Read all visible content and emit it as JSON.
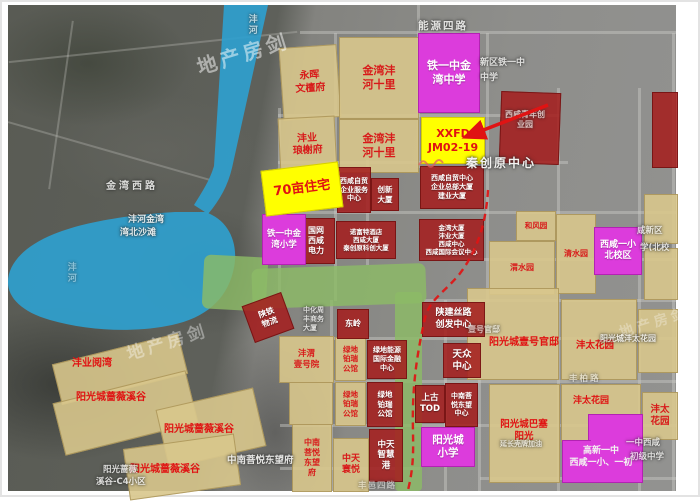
{
  "watermark": {
    "text": "地产房剑"
  },
  "colors": {
    "water": "#2f9fce",
    "park_green": "#8cbb67",
    "highlight_yellow": "#ffff00",
    "school_magenta": "#dc3cdc",
    "office_red": "#a41f1f",
    "residential_tan": "#d8c68c",
    "label_red": "#e01212",
    "route_red": "#e01313"
  },
  "blocks": {
    "zhuzhai70": "70亩住宅",
    "xxfd": "XXFD\nJM02-19",
    "tieyi_zhongxue": "铁一中金\n湾中学",
    "tieyi_xiaoxue": "铁一中金\n湾小学",
    "xixian_yixiao_bei": "西咸一小\n北校区",
    "gaoxin_yizhong": "高新一中\n西咸一小、一初",
    "yangguangcheng_xiaoxue": "阳光城\n小学",
    "ziyou_fuwu": "西咸自贸\n企业服务\n中心",
    "chuangxin_dasha": "创新\n大厦",
    "zongbu_dasha": "西咸自贸中心\n企业总部大厦\n建业大厦",
    "guowang_dianli": "国网\n西咸\n电力",
    "nuofute": "诺富特酒店\n西咸大厦\n秦创原科创大厦",
    "jinwan_dasha": "金湾大厦\n沣业大厦\n西咸中心\n西咸国际会议中心",
    "dongling": "东岭",
    "lvdi_jinrong": "绿地能源\n国际金融\n中心",
    "lvdi_bairui_hong": "绿地\n铂瑞\n公馆",
    "zhongtian_zhihuigang": "中天\n智慧\n港",
    "shanjian_silu": "陕建丝路\n创发中心",
    "tianzhong_zhongxin": "天众\n中心",
    "shanggu_tod": "上古\nTOD",
    "zhongnan_zhongxin": "中南菩\n悦东望\n中心",
    "shantie_wuliu": "陕铁\n物流",
    "yonghui": "永晖\n文檀府",
    "jinwan_shili_1": "金湾沣\n河十里",
    "jinwan_shili_2": "金湾沣\n河十里",
    "fengye_langxie": "沣业\n琅榭府",
    "hefengyuan": "和风园",
    "weishuiyuan": "渭水园",
    "qingshuiyuan": "清水园",
    "fengwei_yihaoyuan": "沣渭\n壹号院",
    "lvdi_bairui_1": "绿地\n铂瑞\n公馆",
    "lvdi_bairui_2": "绿地\n铂瑞\n公馆",
    "zhongnan_dongwangfu": "中南\n菩悦\n东望\n府",
    "zhongtian_huanyue": "中天\n寰悦",
    "fengtai_small": "沣太\n花园"
  },
  "area_labels": {
    "fengye_yuewan": "沣业阅湾",
    "qiangwei_1": "阳光城蔷薇溪谷",
    "qiangwei_2": "阳光城蔷薇溪谷",
    "qiangwei_3": "阳光城蔷薇溪谷",
    "yihao_guandi": "阳光城壹号官邸",
    "fengtai_1": "沣太花园",
    "fengtai_2": "沣太花园",
    "basai": "阳光城巴塞\n阳光"
  },
  "bg_labels": {
    "nengyuan_silu": "能源四路",
    "jinwan_xilu": "金湾西路",
    "qinchuangyuan": "秦创原中心",
    "fenghe_jinwan": "沣河金湾",
    "wanbei_shatan": "湾北沙滩",
    "fenghe_river": "沣河",
    "fenghe_lake": "沣河",
    "xinqu_tieyi": "新区铁一中",
    "zhongxue": "中学",
    "qingnian_chuangye": "西咸青年创\n业园",
    "xian_xinqu": "咸新区",
    "xue_beixiao": "学(北校",
    "zhonghua_shangwu": "中化周\n丰商务\n大厦",
    "zhongnan_bg": "中南菩悦东望府",
    "yihao_bg": "壹号官邸",
    "fengtai_bg": "阳光城沣太花园",
    "yanchang": "延长壳牌加油",
    "yizhong_xixian": "一中西咸",
    "chuji_zhongxue": "初级中学",
    "c4_line1": "阳光蔷薇",
    "c4_line2": "溪谷-C4小区",
    "fengbai_lu": "丰柏路",
    "fengyi_lu": "丰邑四路"
  }
}
